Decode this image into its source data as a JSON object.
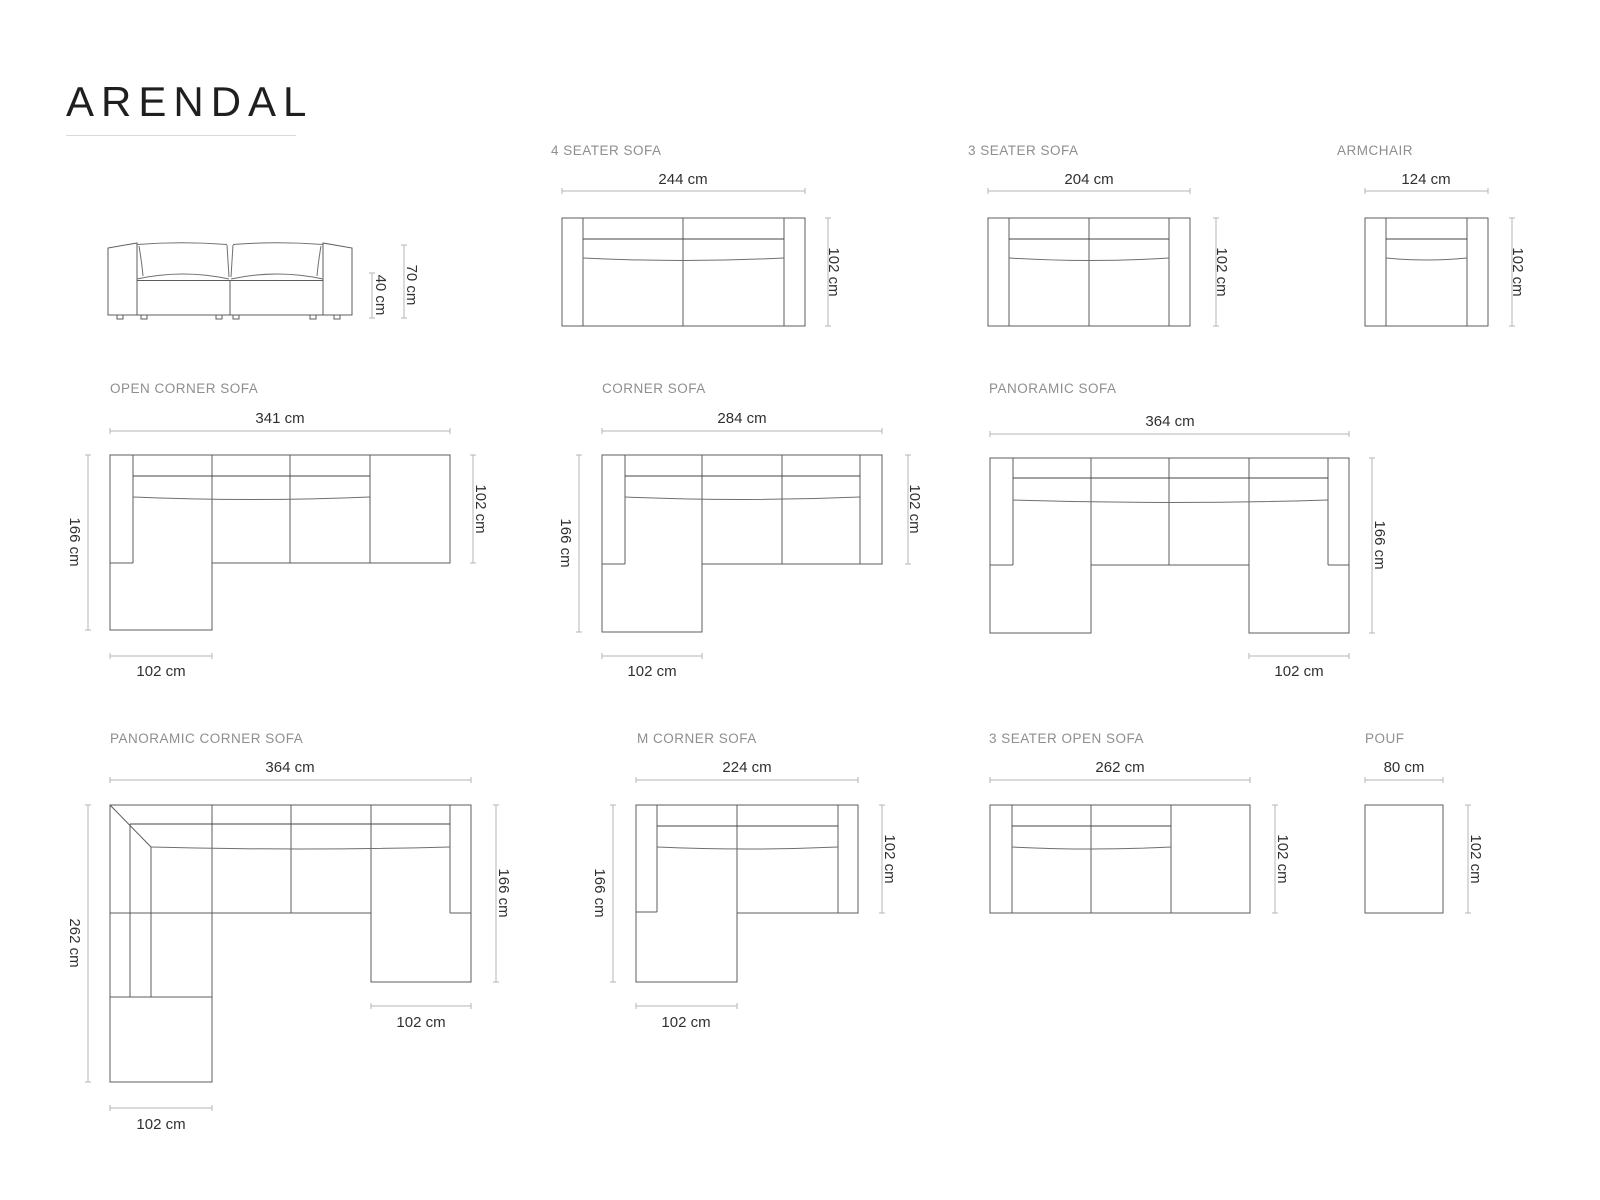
{
  "brand": {
    "title": "ARENDAL"
  },
  "products": {
    "front_view": {
      "total_height": "70 cm",
      "seat_height": "40 cm"
    },
    "four_seater": {
      "label": "4 SEATER SOFA",
      "width": "244 cm",
      "depth": "102 cm"
    },
    "three_seater": {
      "label": "3 SEATER SOFA",
      "width": "204 cm",
      "depth": "102 cm"
    },
    "armchair": {
      "label": "ARMCHAIR",
      "width": "124 cm",
      "depth": "102 cm"
    },
    "open_corner": {
      "label": "OPEN CORNER SOFA",
      "width": "341 cm",
      "depth": "102 cm",
      "total_depth": "166 cm",
      "chaise_width": "102 cm"
    },
    "corner": {
      "label": "CORNER SOFA",
      "width": "284 cm",
      "depth": "102 cm",
      "total_depth": "166 cm",
      "chaise_width": "102 cm"
    },
    "panoramic": {
      "label": "PANORAMIC SOFA",
      "width": "364 cm",
      "total_depth": "166 cm",
      "chaise_width": "102 cm"
    },
    "panoramic_corner": {
      "label": "PANORAMIC CORNER SOFA",
      "width": "364 cm",
      "left_depth": "262 cm",
      "right_depth": "166 cm",
      "right_chaise_width": "102 cm",
      "bottom_chaise_width": "102 cm"
    },
    "m_corner": {
      "label": "M CORNER SOFA",
      "width": "224 cm",
      "depth": "102 cm",
      "total_depth": "166 cm",
      "chaise_width": "102 cm"
    },
    "three_seater_open": {
      "label": "3 SEATER OPEN SOFA",
      "width": "262 cm",
      "depth": "102 cm"
    },
    "pouf": {
      "label": "POUF",
      "width": "80 cm",
      "depth": "102 cm"
    }
  }
}
